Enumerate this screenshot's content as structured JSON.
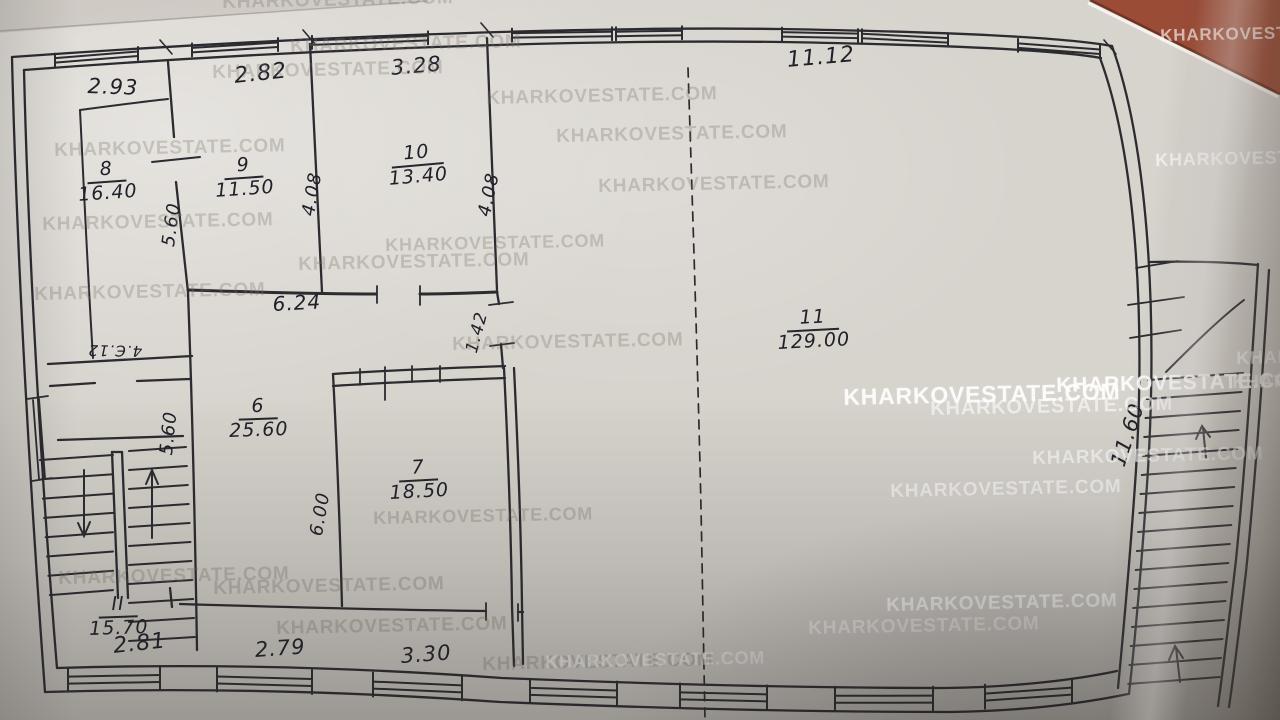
{
  "photo": {
    "description": "Photographed hand-drawn floor plan on paper, desk visible at top-right corner",
    "paper_color": "#d7d3cd",
    "ink_color": "#2b2b30",
    "desk_color": "#9a4c36"
  },
  "watermark_text": "KHARKOVESTATE.COM",
  "watermarks": [
    {
      "x": 222,
      "y": -8,
      "size": 19,
      "variant": "g"
    },
    {
      "x": 290,
      "y": 36,
      "size": 19,
      "variant": "g"
    },
    {
      "x": 212,
      "y": 62,
      "size": 19,
      "variant": "g"
    },
    {
      "x": 486,
      "y": 88,
      "size": 19,
      "variant": "g"
    },
    {
      "x": 556,
      "y": 126,
      "size": 19,
      "variant": "g"
    },
    {
      "x": 598,
      "y": 176,
      "size": 19,
      "variant": "g"
    },
    {
      "x": 54,
      "y": 140,
      "size": 19,
      "variant": "g"
    },
    {
      "x": 42,
      "y": 214,
      "size": 19,
      "variant": "g"
    },
    {
      "x": 385,
      "y": 235,
      "size": 18,
      "variant": "g"
    },
    {
      "x": 298,
      "y": 254,
      "size": 19,
      "variant": "g"
    },
    {
      "x": 34,
      "y": 284,
      "size": 19,
      "variant": "g"
    },
    {
      "x": 452,
      "y": 334,
      "size": 19,
      "variant": "g"
    },
    {
      "x": 843,
      "y": 384,
      "size": 23,
      "variant": "b"
    },
    {
      "x": 930,
      "y": 398,
      "size": 20,
      "variant": "w"
    },
    {
      "x": 1056,
      "y": 374,
      "size": 21,
      "variant": "b"
    },
    {
      "x": 1032,
      "y": 448,
      "size": 19,
      "variant": "w"
    },
    {
      "x": 890,
      "y": 481,
      "size": 19,
      "variant": "w"
    },
    {
      "x": 373,
      "y": 508,
      "size": 18,
      "variant": "g"
    },
    {
      "x": 58,
      "y": 568,
      "size": 19,
      "variant": "g"
    },
    {
      "x": 213,
      "y": 578,
      "size": 19,
      "variant": "g"
    },
    {
      "x": 276,
      "y": 618,
      "size": 19,
      "variant": "g"
    },
    {
      "x": 886,
      "y": 595,
      "size": 19,
      "variant": "b"
    },
    {
      "x": 808,
      "y": 618,
      "size": 19,
      "variant": "w"
    },
    {
      "x": 482,
      "y": 654,
      "size": 19,
      "variant": "g"
    },
    {
      "x": 545,
      "y": 652,
      "size": 18,
      "variant": "w"
    },
    {
      "x": 1155,
      "y": 150,
      "size": 18,
      "variant": "w"
    },
    {
      "x": 1160,
      "y": 26,
      "size": 17,
      "variant": "w"
    },
    {
      "x": 1236,
      "y": 348,
      "size": 18,
      "variant": "w"
    },
    {
      "x": 1232,
      "y": 372,
      "size": 18,
      "variant": "w"
    }
  ],
  "rooms": [
    {
      "number": "8",
      "area": "16.40",
      "x": 76,
      "y": 162,
      "rot": -4
    },
    {
      "number": "9",
      "area": "11.50",
      "x": 213,
      "y": 158,
      "rot": -4
    },
    {
      "number": "10",
      "area": "13.40",
      "x": 386,
      "y": 146,
      "rot": -5
    },
    {
      "number": "11",
      "area": "129.00",
      "x": 776,
      "y": 310,
      "rot": -3
    },
    {
      "number": "6",
      "area": "25.60",
      "x": 228,
      "y": 398,
      "rot": -2
    },
    {
      "number": "7",
      "area": "18.50",
      "x": 388,
      "y": 460,
      "rot": -3
    },
    {
      "number": "II",
      "area": "15.70",
      "x": 88,
      "y": 596,
      "rot": -2
    }
  ],
  "dimensions": [
    {
      "value": "2.93",
      "x": 88,
      "y": 74,
      "rot": 2,
      "size": 21
    },
    {
      "value": "2.82",
      "x": 233,
      "y": 64,
      "rot": -6,
      "size": 22
    },
    {
      "value": "3.28",
      "x": 390,
      "y": 56,
      "rot": -5,
      "size": 21
    },
    {
      "value": "11.12",
      "x": 786,
      "y": 48,
      "rot": -5,
      "size": 22
    },
    {
      "value": "6.24",
      "x": 272,
      "y": 292,
      "rot": -3,
      "size": 20
    },
    {
      "value": "5.60",
      "x": 158,
      "y": 245,
      "rot": -82,
      "size": 18
    },
    {
      "value": "4.08",
      "x": 298,
      "y": 214,
      "rot": -80,
      "size": 18
    },
    {
      "value": "4.08",
      "x": 474,
      "y": 214,
      "rot": -78,
      "size": 18
    },
    {
      "value": "5.60",
      "x": 156,
      "y": 454,
      "rot": -84,
      "size": 18
    },
    {
      "value": "6.00",
      "x": 306,
      "y": 534,
      "rot": -80,
      "size": 18
    },
    {
      "value": "1.42",
      "x": 462,
      "y": 350,
      "rot": -75,
      "size": 17
    },
    {
      "value": "11.60",
      "x": 1106,
      "y": 462,
      "rot": -72,
      "size": 21
    },
    {
      "value": "2.81",
      "x": 112,
      "y": 634,
      "rot": -6,
      "size": 22
    },
    {
      "value": "2.79",
      "x": 254,
      "y": 638,
      "rot": -4,
      "size": 21
    },
    {
      "value": "3.30",
      "x": 400,
      "y": 644,
      "rot": -4,
      "size": 21
    },
    {
      "value": "4.Є.12",
      "x": 142,
      "y": 360,
      "rot": 181,
      "size": 15
    }
  ]
}
